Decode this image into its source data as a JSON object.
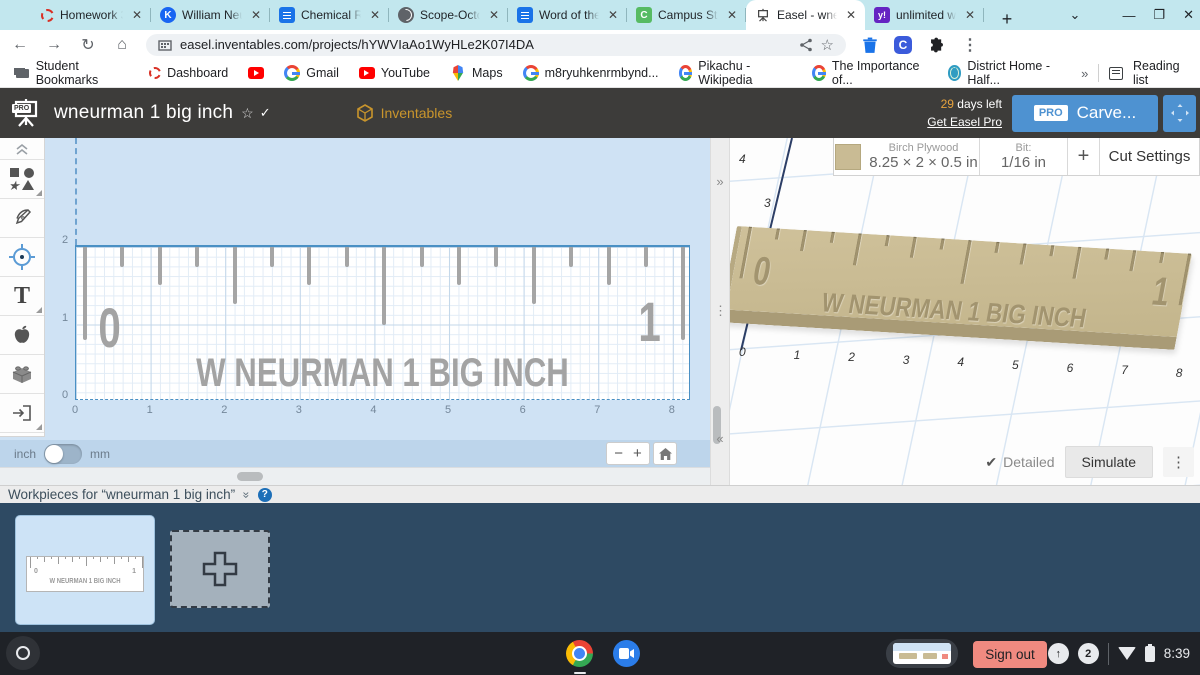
{
  "tabstrip": {
    "tabs": [
      {
        "title": "Homework 3/7",
        "icon": "dashed-red",
        "active": false
      },
      {
        "title": "William Neurm",
        "icon": "khan",
        "active": false
      },
      {
        "title": "Chemical Rea",
        "icon": "gdoc",
        "active": false
      },
      {
        "title": "Scope-Octobe",
        "icon": "globe-dark",
        "active": false
      },
      {
        "title": "Word of the d",
        "icon": "gdoc",
        "active": false
      },
      {
        "title": "Campus Stud",
        "icon": "campus",
        "active": false
      },
      {
        "title": "Easel - wneurm",
        "icon": "easel",
        "active": true
      },
      {
        "title": "unlimited wor",
        "icon": "ydict",
        "active": false
      }
    ],
    "tab_icon_letters": {
      "khan": "K",
      "campus": "C",
      "ydict": "y!"
    },
    "new_tab": "+",
    "close_glyph": "✕"
  },
  "navbar": {
    "url": "easel.inventables.com/projects/hYWVIaAo1WyHLe2K07I4DA",
    "back": "←",
    "forward": "→",
    "reload": "↻",
    "home": "⌂",
    "share": "<",
    "star": "☆",
    "menu": "⋮"
  },
  "bookmarks": {
    "items": [
      {
        "label": "Student Bookmarks",
        "icon": "folder"
      },
      {
        "label": "Dashboard",
        "icon": "dashed-red"
      },
      {
        "label": "",
        "icon": "youtube"
      },
      {
        "label": "Gmail",
        "icon": "google-g"
      },
      {
        "label": "YouTube",
        "icon": "youtube"
      },
      {
        "label": "Maps",
        "icon": "maps-pin"
      },
      {
        "label": "m8ryuhkenrmbynd...",
        "icon": "google-g"
      },
      {
        "label": "Pikachu - Wikipedia",
        "icon": "google-g"
      },
      {
        "label": "The Importance of...",
        "icon": "google-g"
      },
      {
        "label": "District Home - Half...",
        "icon": "globe"
      }
    ],
    "overflow": "»",
    "reading_list": "Reading list"
  },
  "header": {
    "logo_badge": "PRO",
    "title": "wneurman 1 big inch",
    "star": "☆",
    "check": "✓",
    "menus": [
      "Project",
      "Edit",
      "Machine",
      "Toolbox",
      "Help"
    ],
    "brand": "Inventables",
    "trial_days": "29",
    "trial_rest": " days left",
    "upgrade": "Get Easel Pro",
    "pro_badge": "PRO",
    "carve": "Carve..."
  },
  "toolbar": {
    "collapse": "collapse-toolbar",
    "tools": [
      "shapes-tool",
      "pen-tool",
      "drill-tool",
      "text-tool",
      "design-library-tool",
      "three-d-tool",
      "import-tool"
    ],
    "text_tool_glyph": "T"
  },
  "canvas": {
    "y_labels": [
      "2",
      "1",
      "0"
    ],
    "x_labels": [
      "0",
      "1",
      "2",
      "3",
      "4",
      "5",
      "6",
      "7",
      "8"
    ],
    "design": {
      "left_numeral": "0",
      "right_numeral": "1",
      "engraving": "W NEURMAN 1 BIG INCH",
      "ticks": 17
    },
    "units_left": "inch",
    "units_right": "mm",
    "zoom_out": "−",
    "zoom_in": "+",
    "expand": "»",
    "collapse": "«",
    "drag_dots": "⋮"
  },
  "preview": {
    "material_name": "Birch Plywood",
    "material_dims": "8.25 × 2 × 0.5 in",
    "bit_label": "Bit:",
    "bit_value": "1/16 in",
    "add_bit": "+",
    "cut_settings": "Cut Settings",
    "x_labels": [
      "0",
      "1",
      "2",
      "3",
      "4",
      "5",
      "6",
      "7",
      "8"
    ],
    "y_labels": [
      "4",
      "3"
    ],
    "board": {
      "left_numeral": "0",
      "right_numeral": "1",
      "engraving": "W NEURMAN 1 BIG INCH",
      "ticks": 17
    },
    "detailed_check": "✔",
    "detailed": "Detailed",
    "simulate": "Simulate",
    "kebab": "⋮"
  },
  "workpieces": {
    "title": "Workpieces for “wneurman 1 big inch”",
    "chevrons": "»",
    "help": "?",
    "thumb": {
      "left_numeral": "0",
      "right_numeral": "1",
      "engraving": "W NEURMAN 1 BIG INCH",
      "ticks": 17
    }
  },
  "shelf": {
    "sign_out": "Sign out",
    "notifications": "2",
    "time": "8:39"
  }
}
